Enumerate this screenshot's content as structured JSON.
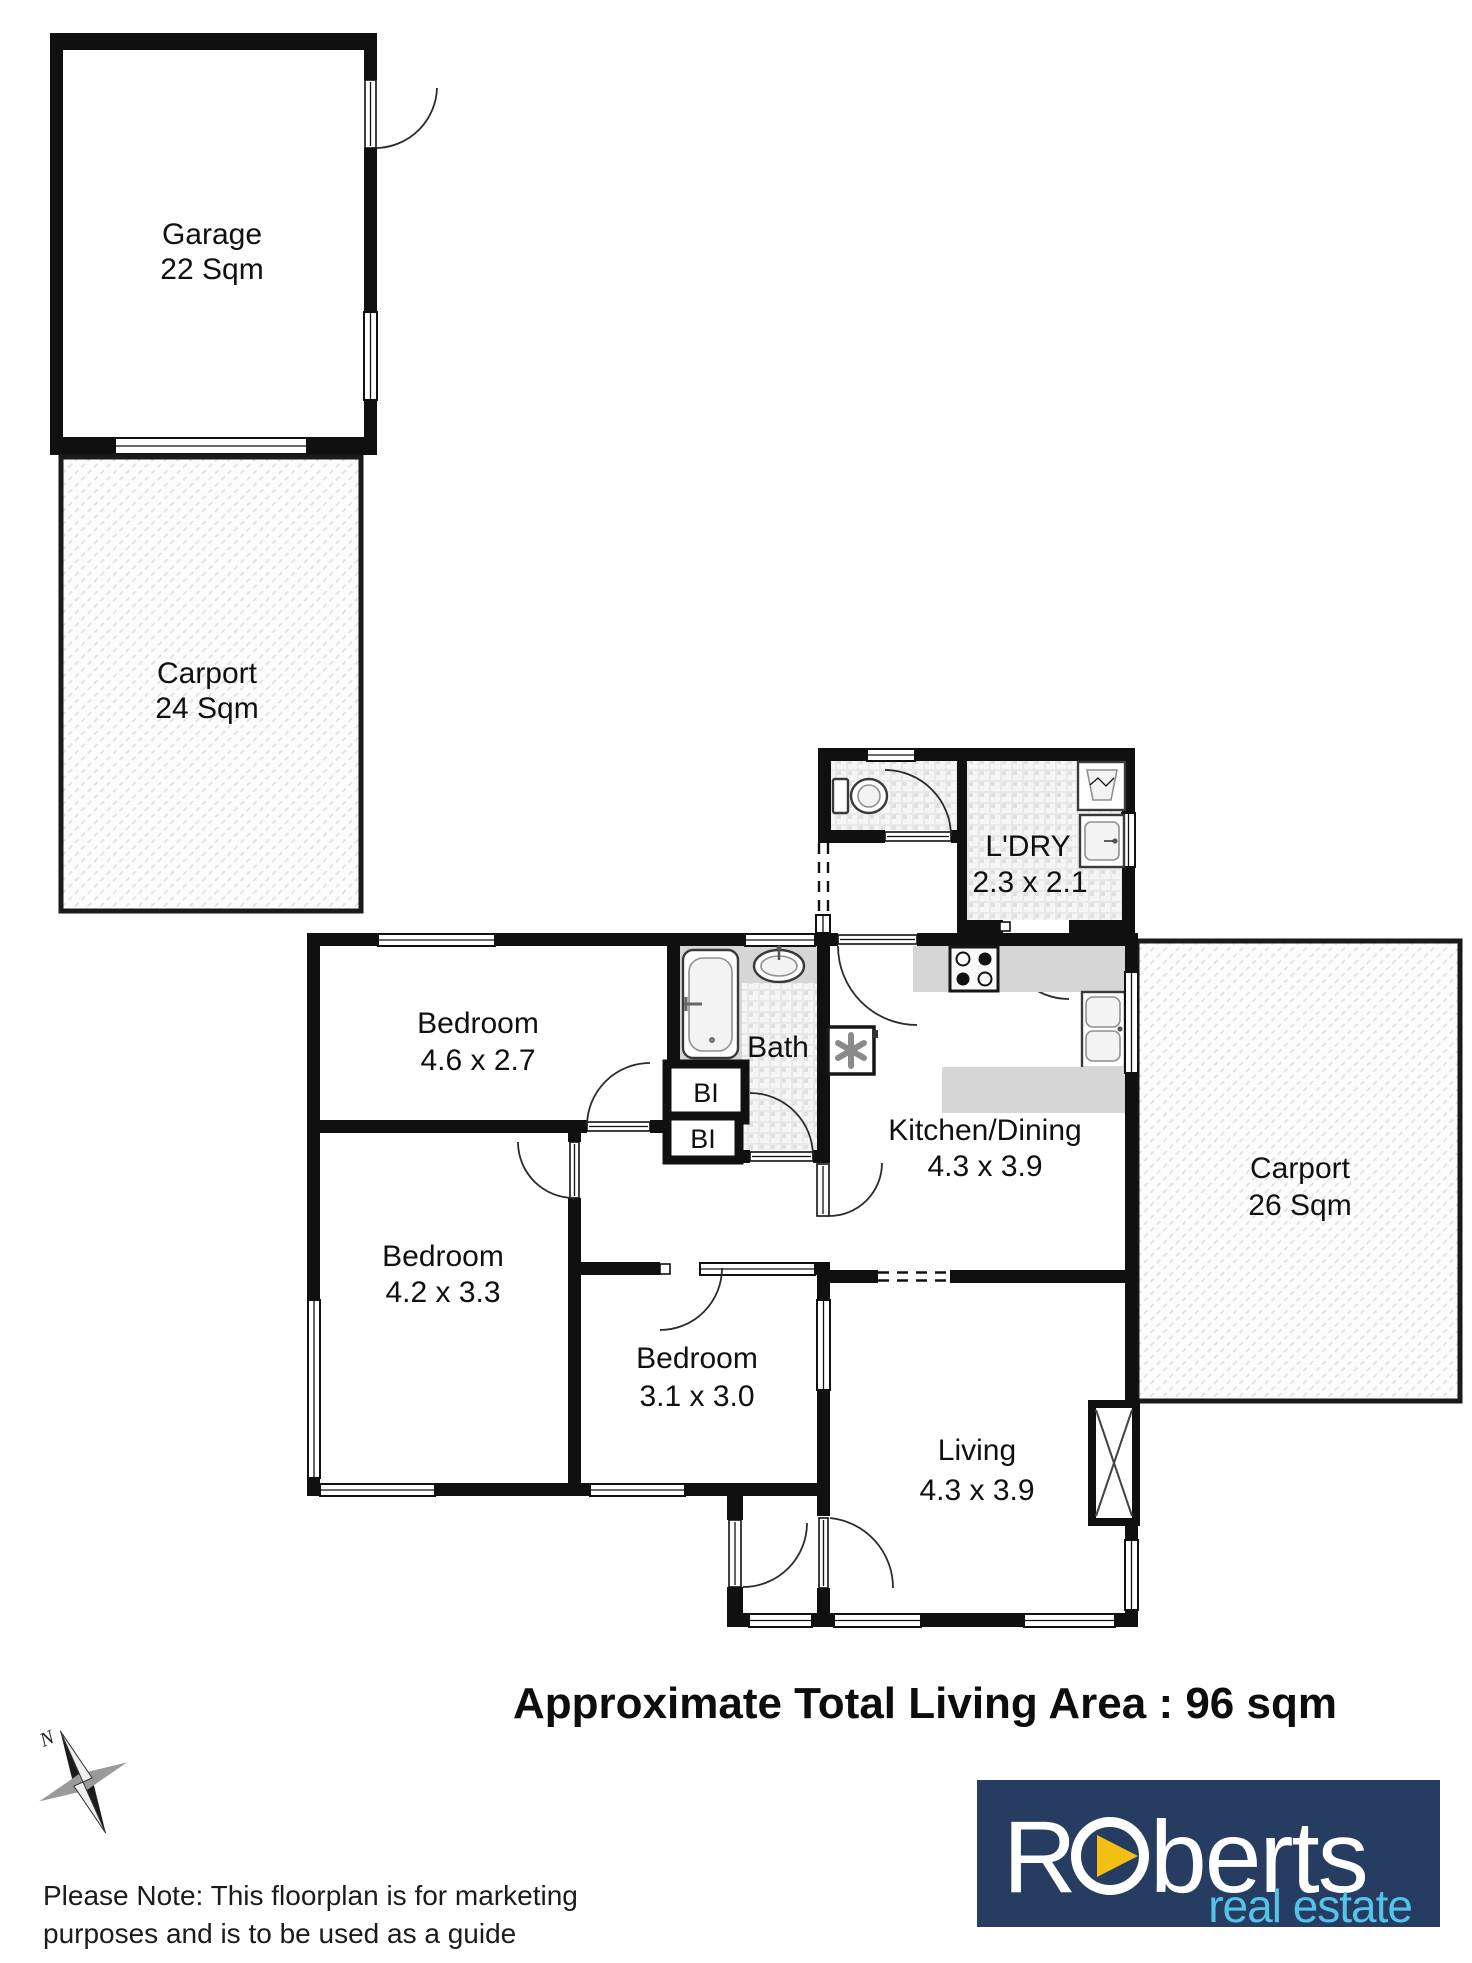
{
  "plan": {
    "garage": {
      "name": "Garage",
      "area": "22 Sqm"
    },
    "carport_upper": {
      "name": "Carport",
      "area": "24 Sqm"
    },
    "carport_right": {
      "name": "Carport",
      "area": "26 Sqm"
    },
    "laundry": {
      "name": "L'DRY",
      "dims": "2.3 x 2.1"
    },
    "bath": {
      "name": "Bath"
    },
    "built_in_1": {
      "name": "BI"
    },
    "built_in_2": {
      "name": "BI"
    },
    "kitchen": {
      "name": "Kitchen/Dining",
      "dims": "4.3 x 3.9"
    },
    "bedroom_1": {
      "name": "Bedroom",
      "dims": "4.6 x 2.7"
    },
    "bedroom_2": {
      "name": "Bedroom",
      "dims": "4.2 x 3.3"
    },
    "bedroom_3": {
      "name": "Bedroom",
      "dims": "3.1 x 3.0"
    },
    "living": {
      "name": "Living",
      "dims": "4.3 x 3.9"
    }
  },
  "footer": {
    "total_area": "Approximate Total Living Area : 96 sqm",
    "note_line1": "Please Note: This floorplan is for marketing",
    "note_line2": "purposes and is to be used as a guide",
    "compass_label": "N"
  },
  "logo": {
    "part1": "R",
    "part2": "berts",
    "tagline": "real estate",
    "colors": {
      "navy": "#263c60",
      "blue": "#55c3e8",
      "yellow": "#f2c014"
    }
  }
}
